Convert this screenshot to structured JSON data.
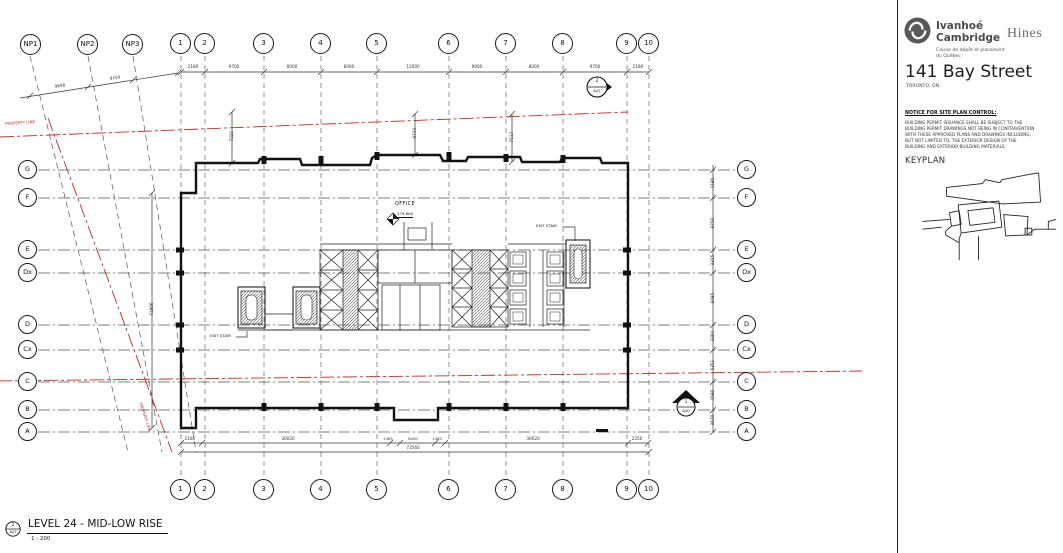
{
  "titleblock": {
    "brand_line1": "Ivanhoé",
    "brand_line2": "Cambridge",
    "partner": "Hines",
    "caisse_line1": "Caisse de dépôt et placement",
    "caisse_line2": "du Québec",
    "project_title": "141 Bay Street",
    "project_location": "TORONTO, ON",
    "notice_heading": "NOTICE FOR SITE PLAN CONTROL:",
    "notice_body": "BUILDING PERMIT ISSUANCE SHALL BE SUBJECT TO THE BUILDING PERMIT DRAWINGS NOT BEING IN CONTRAVENTION WITH THESE APPROVED PLANS AND DRAWINGS INCLUDING, BUT NOT LIMITED TO, THE EXTERIOR DESIGN OF THE BUILDING AND EXTERIOR BUILDING MATERIALS.",
    "keyplan_label": "KEYPLAN"
  },
  "plan": {
    "grid_top": [
      "NP1",
      "NP2",
      "NP3",
      "1",
      "2",
      "3",
      "4",
      "5",
      "6",
      "7",
      "8",
      "9",
      "10"
    ],
    "grid_bottom": [
      "1",
      "2",
      "3",
      "4",
      "5",
      "6",
      "7",
      "8",
      "9",
      "10"
    ],
    "grid_side": [
      "G",
      "F",
      "E",
      "Dx",
      "D",
      "Cx",
      "C",
      "B",
      "A"
    ],
    "dims_top": [
      "2180",
      "9700",
      "8000",
      "8000",
      "12000",
      "9000",
      "8000",
      "9700",
      "2180"
    ],
    "dims_right": [
      "4180",
      "8750",
      "3325",
      "8485",
      "3364",
      "5351",
      "4580",
      "3670"
    ],
    "dims_bottom": [
      "2180",
      "30020",
      "1485",
      "6000",
      "1485",
      "30020",
      "2250"
    ],
    "dims_bottom_total": "73560",
    "dims_np": [
      "9648",
      "9104"
    ],
    "dims_interior": [
      "7221",
      "9744",
      "7117",
      "41806"
    ],
    "labels": {
      "office": "OFFICE",
      "office_level": "179.800",
      "exit_stair": "EXIT STAIR",
      "property_line": "PROPERTY LINE"
    },
    "markers": {
      "sec_a": {
        "num": "2",
        "sheet": "A27"
      },
      "sec_b": {
        "num": "1",
        "sheet": "A40"
      }
    }
  },
  "view": {
    "callout_num": "2",
    "callout_sheet": "A27",
    "title": "LEVEL 24 - MID-LOW RISE",
    "scale": "1 : 200"
  }
}
